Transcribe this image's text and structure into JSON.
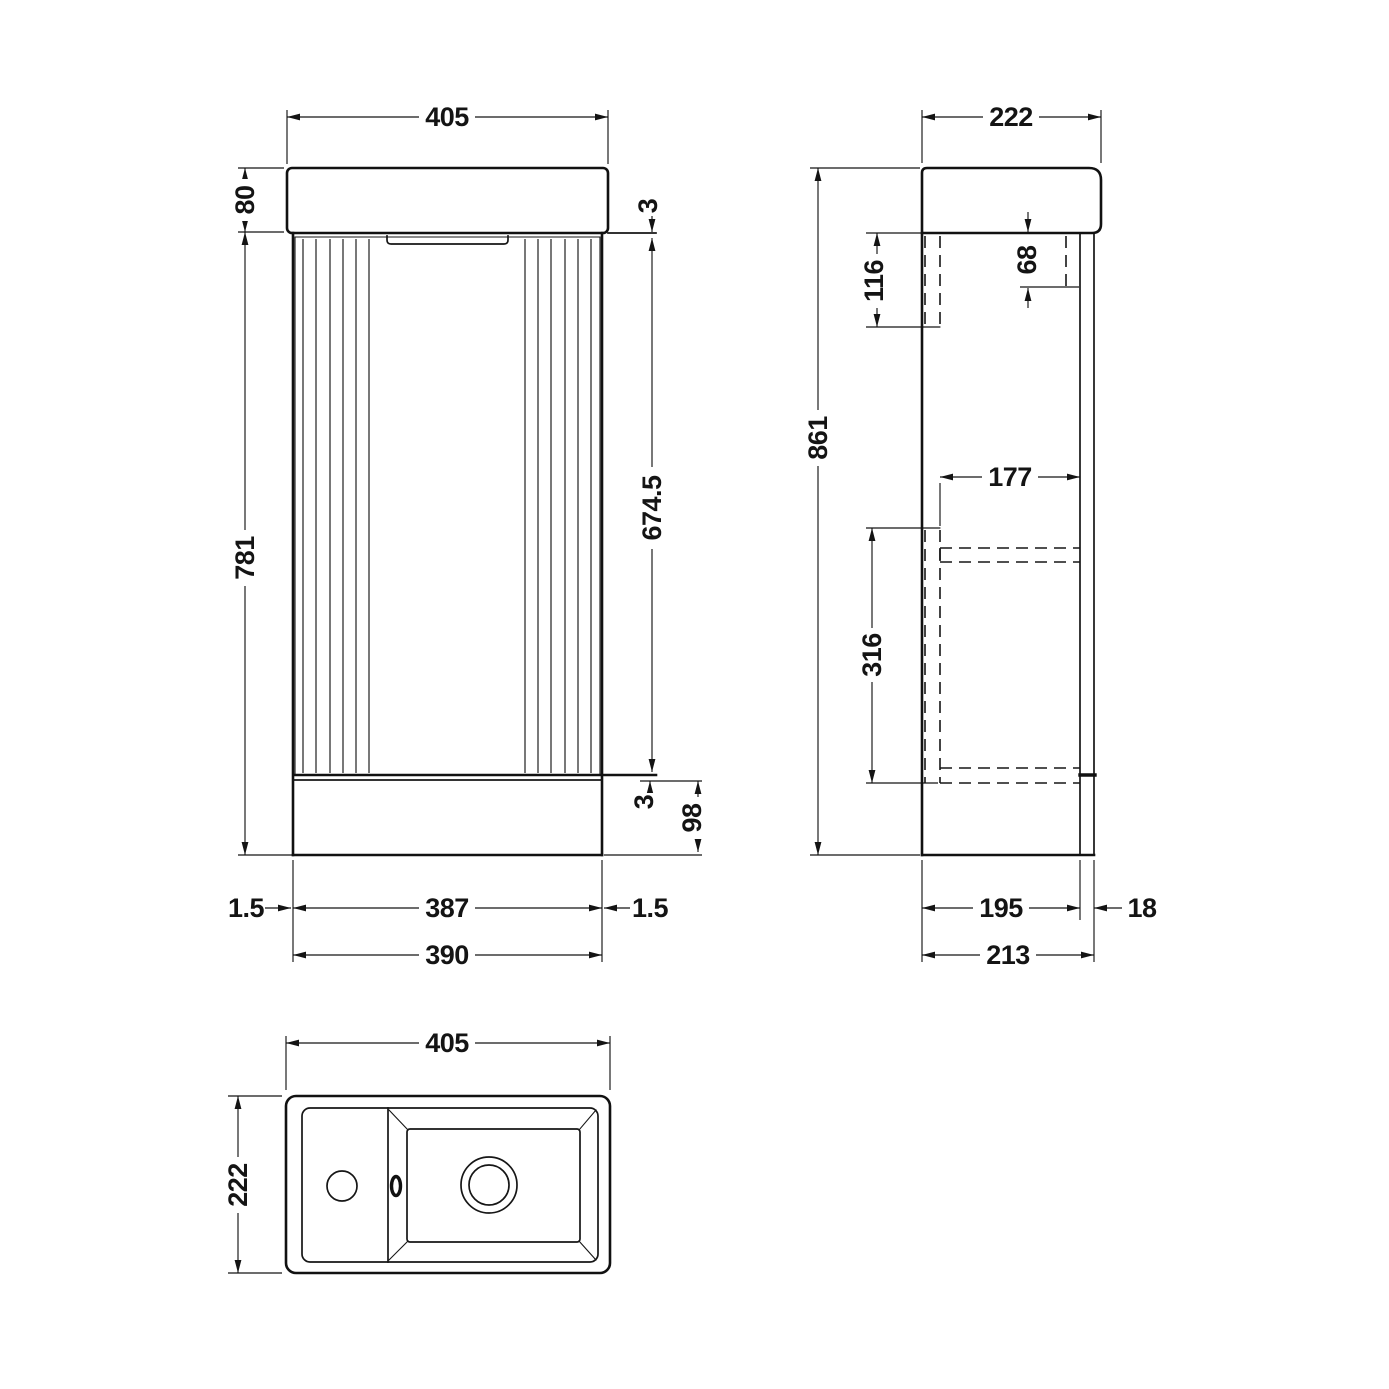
{
  "views": {
    "front": {
      "dims": {
        "basin_width": "405",
        "worktop_height": "80",
        "top_gap": "3",
        "door_height": "674.5",
        "cabinet_height": "781",
        "bottom_gap": "3",
        "plinth_height": "98",
        "left_gap": "1.5",
        "door_width": "387",
        "right_gap": "1.5",
        "cabinet_width": "390"
      }
    },
    "side": {
      "dims": {
        "basin_depth": "222",
        "overall_height": "861",
        "back_fixing_height": "116",
        "front_fixing_height": "68",
        "internal_depth": "177",
        "internal_back_height": "316",
        "carcass_depth": "195",
        "door_thickness": "18",
        "overall_depth": "213"
      }
    },
    "plan": {
      "dims": {
        "basin_width": "405",
        "basin_depth": "222"
      }
    }
  }
}
